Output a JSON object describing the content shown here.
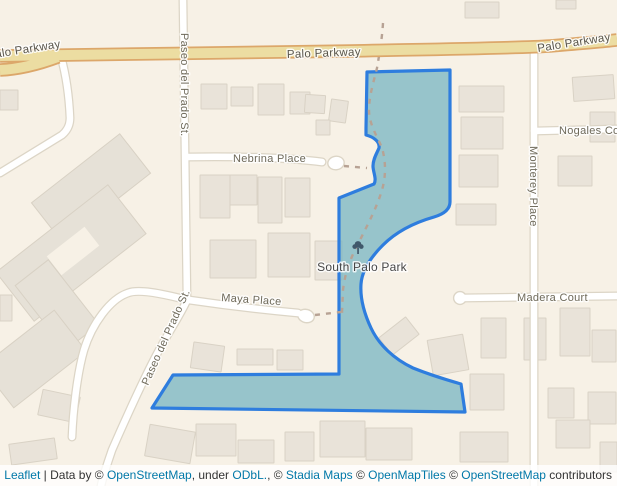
{
  "map": {
    "streets": {
      "palo_parkway_left": "Palo Parkway",
      "palo_parkway_center": "Palo Parkway",
      "palo_parkway_right": "Palo Parkway",
      "paseo_del_prado_upper": "Paseo del Prado St.",
      "paseo_del_prado_lower": "Paseo del Prado St.",
      "nebrina_place": "Nebrina Place",
      "maya_place": "Maya Place",
      "madera_court": "Madera Court",
      "monterey_place": "Monterey Place",
      "nogales_court": "Nogales Court"
    },
    "park": {
      "name": "South Palo Park",
      "icon": "tree"
    },
    "colors": {
      "background": "#f7f1e6",
      "park_fill": "#77b4c2",
      "park_border": "#2e7dde",
      "major_road_fill": "#ecdda2",
      "major_road_casing": "#dca76a",
      "minor_road_fill": "#ffffff",
      "link": "#0078a8"
    }
  },
  "attribution": {
    "leaflet": "Leaflet",
    "sep1": " | Data by © ",
    "openstreetmap_1": "OpenStreetMap",
    "sep2": ", under ",
    "odbl": "ODbL.",
    "sep3": ", © ",
    "stadia_maps": "Stadia Maps",
    "sep4": " © ",
    "openmaptiles": "OpenMapTiles",
    "sep5": " © ",
    "openstreetmap_2": "OpenStreetMap",
    "sep6": " contributors"
  }
}
